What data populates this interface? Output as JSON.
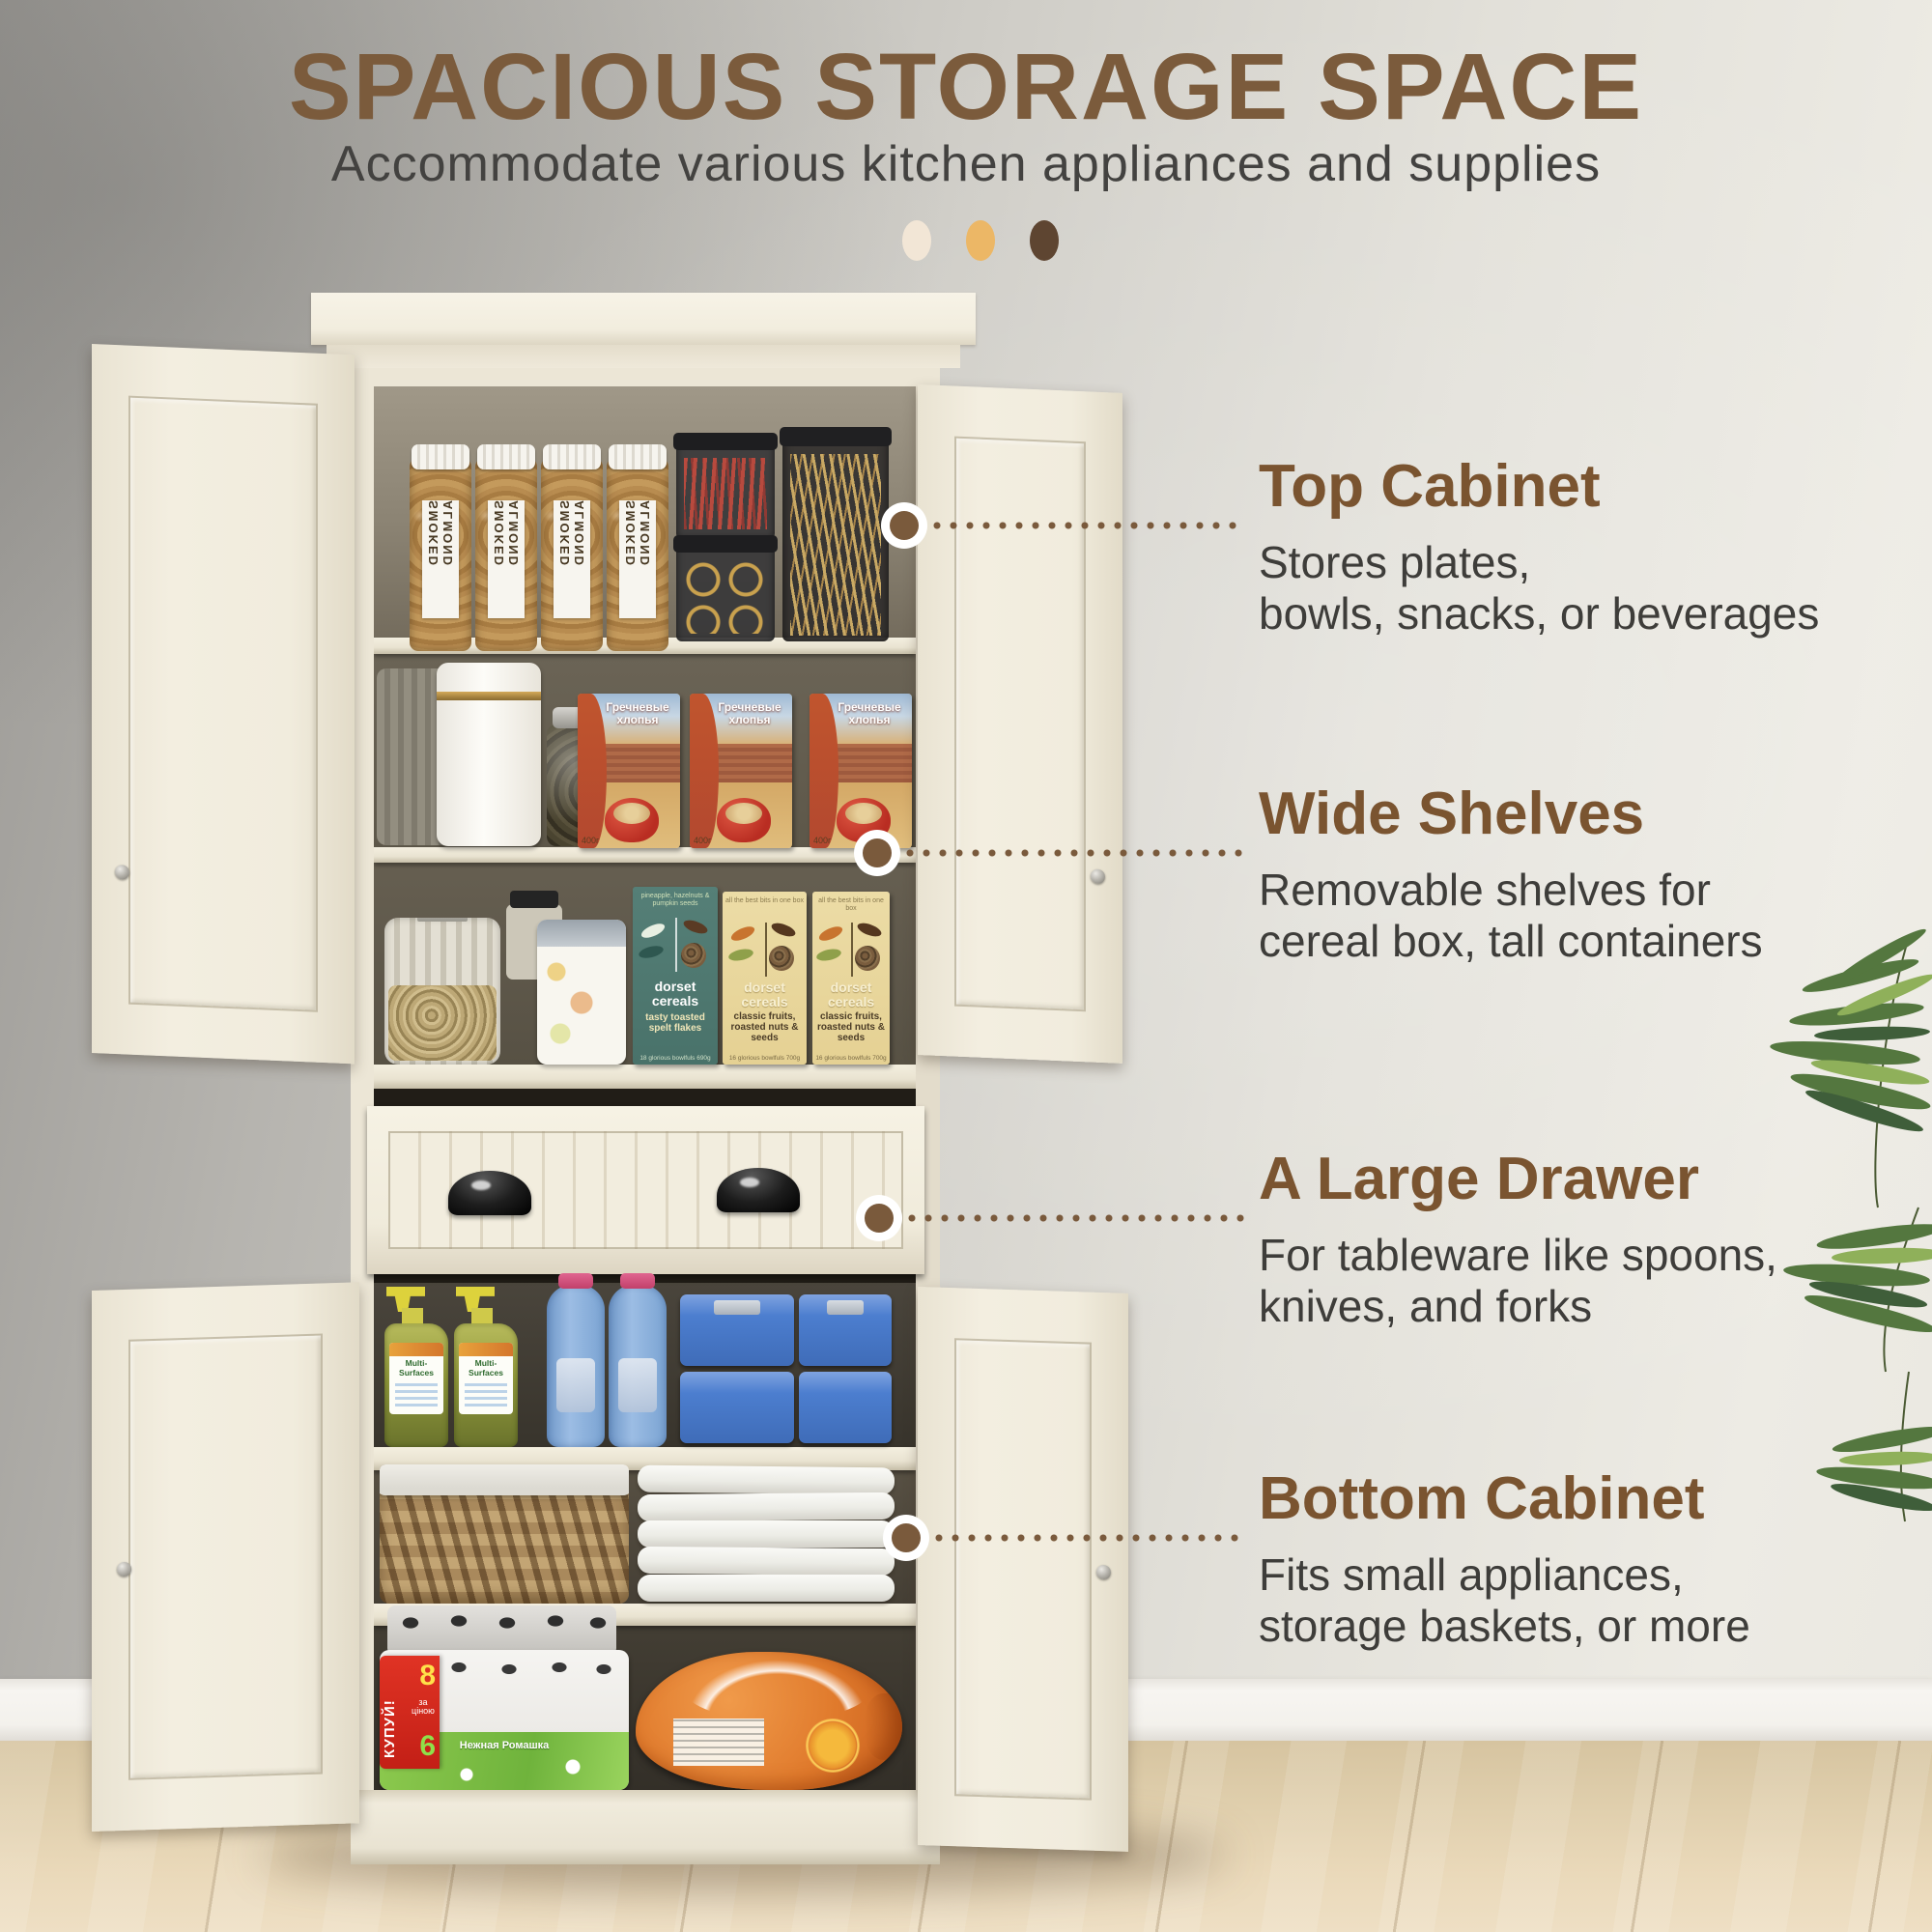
{
  "header": {
    "title": "SPACIOUS STORAGE SPACE",
    "subtitle": "Accommodate various kitchen appliances and supplies",
    "dot_colors": [
      "#f2e6d6",
      "#ecb766",
      "#5e4531"
    ]
  },
  "accent": {
    "heading_brown": "#7a5430",
    "title_brown": "#7b5b3c",
    "body_gray": "#3e3d3a",
    "connector_brown": "#7a5a3c"
  },
  "callouts": [
    {
      "title": "Top Cabinet",
      "body": "Stores plates,\nbowls, snacks, or beverages"
    },
    {
      "title": "Wide Shelves",
      "body": "Removable shelves for\ncereal box, tall containers"
    },
    {
      "title": "A Large Drawer",
      "body": "For tableware like spoons,\nknives, and forks"
    },
    {
      "title": "Bottom Cabinet",
      "body": "Fits small appliances,\nstorage baskets, or more"
    }
  ],
  "products": {
    "almond_label": "SMOKED ALMOND",
    "cereal_title": "Гречневые хлопья",
    "cereal_weight": "400г",
    "dorset_brand": "dorset cereals",
    "dorset_teal_top": "pineapple, hazelnuts & pumpkin seeds",
    "dorset_teal_flavor": "tasty toasted spelt flakes",
    "dorset_teal_size": "18 glorious bowlfuls 690g",
    "dorset_cream_top": "all the best bits in one box",
    "dorset_cream_flavor": "classic fruits, roasted nuts & seeds",
    "dorset_cream_size": "16 glorious bowlfuls 700g",
    "spray_label": "Multi-Surfaces",
    "tp_green_text": "Нежная Ромашка",
    "tp_badge_word": "КУПУЙ!",
    "tp_badge_8": "8",
    "tp_badge_mid": "за ціною",
    "tp_badge_6": "6"
  }
}
